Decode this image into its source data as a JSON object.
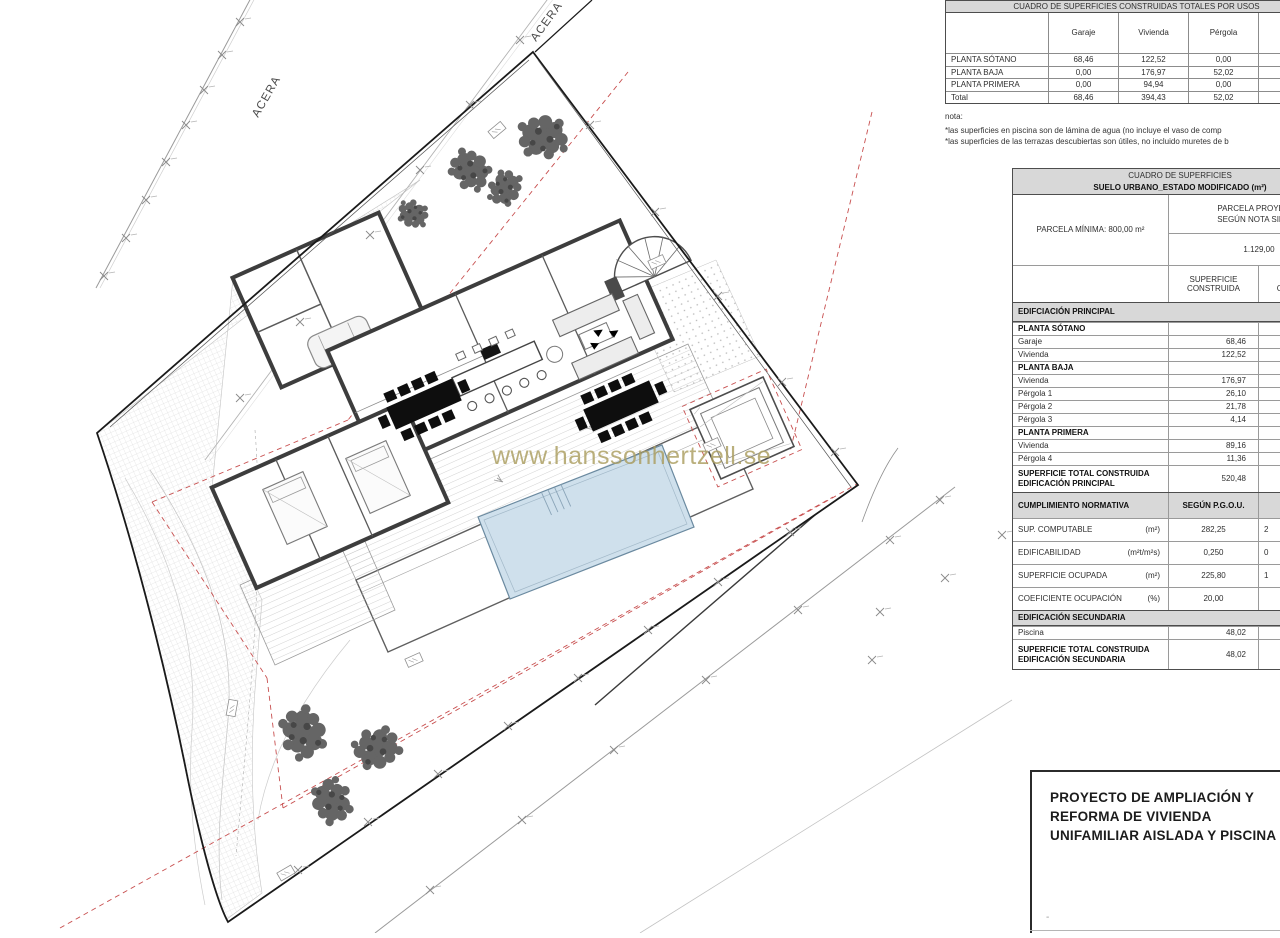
{
  "watermark": "www.hanssonhertzell.se",
  "plan": {
    "acera_left": "ACERA",
    "acera_top": "ACERA",
    "pool_color": "#cfe0ec",
    "red_dashed_color": "#c85050",
    "tree_color": "#656565",
    "wall_color": "#3d3d3d"
  },
  "usage_table": {
    "title": "CUADRO DE SUPERFICIES CONSTRUIDAS TOTALES POR USOS",
    "columns": [
      "Garaje",
      "Vivienda",
      "Pérgola"
    ],
    "rows": [
      {
        "label": "PLANTA SÓTANO",
        "values": [
          "68,46",
          "122,52",
          "0,00"
        ]
      },
      {
        "label": "PLANTA BAJA",
        "values": [
          "0,00",
          "176,97",
          "52,02"
        ]
      },
      {
        "label": "PLANTA PRIMERA",
        "values": [
          "0,00",
          "94,94",
          "0,00"
        ]
      },
      {
        "label": "Total",
        "values": [
          "68,46",
          "394,43",
          "52,02"
        ]
      }
    ],
    "note_heading": "nota:",
    "notes": [
      "*las superficies en piscina son de lámina de agua (no incluye el vaso de comp",
      "*las superficies de las terrazas descubiertas son útiles, no incluido muretes de b"
    ]
  },
  "surfaces_table": {
    "title_line1": "CUADRO DE SUPERFICIES",
    "title_line2": "SUELO URBANO_ESTADO MODIFICADO (m²)",
    "parcela_minima": "PARCELA MÍNIMA: 800,00 m²",
    "parcela_proyecto_line1": "PARCELA PROYECTO",
    "parcela_proyecto_line2": "SEGÚN NOTA SIMPLE",
    "parcela_value": "1.129,00",
    "col_construida_l1": "SUPERFICIE",
    "col_construida_l2": "CONSTRUIDA",
    "col_computable_l1": "SUPERFICIE",
    "col_computable_l2": "COMPUTABLE",
    "section_principal": "EDIFCIACIÓN PRINCIPAL",
    "principal_rows": [
      {
        "label": "PLANTA SÓTANO",
        "value": "",
        "bold": true
      },
      {
        "label": "Garaje",
        "value": "68,46"
      },
      {
        "label": "Vivienda",
        "value": "122,52"
      },
      {
        "label": "PLANTA BAJA",
        "value": "",
        "bold": true
      },
      {
        "label": "Vivienda",
        "value": "176,97"
      },
      {
        "label": "Pérgola 1",
        "value": "26,10"
      },
      {
        "label": "Pérgola 2",
        "value": "21,78"
      },
      {
        "label": "Pérgola 3",
        "value": "4,14"
      },
      {
        "label": "PLANTA PRIMERA",
        "value": "",
        "bold": true
      },
      {
        "label": "Vivienda",
        "value": "89,16"
      },
      {
        "label": "Pérgola 4",
        "value": "11,36"
      }
    ],
    "principal_total_label_l1": "SUPERFICIE TOTAL CONSTRUIDA",
    "principal_total_label_l2": "EDIFICACIÓN PRINCIPAL",
    "principal_total_value": "520,48",
    "normativa_header": "CUMPLIMIENTO NORMATIVA",
    "normativa_col1": "SEGÚN P.G.O.U.",
    "normativa_col2_l1": "SEGÚN",
    "normativa_col2_l2": "PROYECTO",
    "normativa_rows": [
      {
        "label": "SUP. COMPUTABLE",
        "unit": "(m²)",
        "pgou": "282,25",
        "proyecto": "2"
      },
      {
        "label": "EDIFICABILIDAD",
        "unit": "(m²t/m²s)",
        "pgou": "0,250",
        "proyecto": "0"
      },
      {
        "label": "SUPERFICIE OCUPADA",
        "unit": "(m²)",
        "pgou": "225,80",
        "proyecto": "1"
      },
      {
        "label": "COEFICIENTE OCUPACIÓN",
        "unit": "(%)",
        "pgou": "20,00",
        "proyecto": ""
      }
    ],
    "section_secundaria": "EDIFICACIÓN SECUNDARIA",
    "secundaria_rows": [
      {
        "label": "Piscina",
        "value": "48,02"
      }
    ],
    "secundaria_total_label_l1": "SUPERFICIE TOTAL CONSTRUIDA",
    "secundaria_total_label_l2": "EDIFICACIÓN SECUNDARIA",
    "secundaria_total_value": "48,02"
  },
  "title_block": {
    "line1": "PROYECTO DE AMPLIACIÓN Y",
    "line2": "REFORMA DE VIVIENDA",
    "line3": "UNIFAMILIAR AISLADA Y PISCINA",
    "dash": "-"
  }
}
